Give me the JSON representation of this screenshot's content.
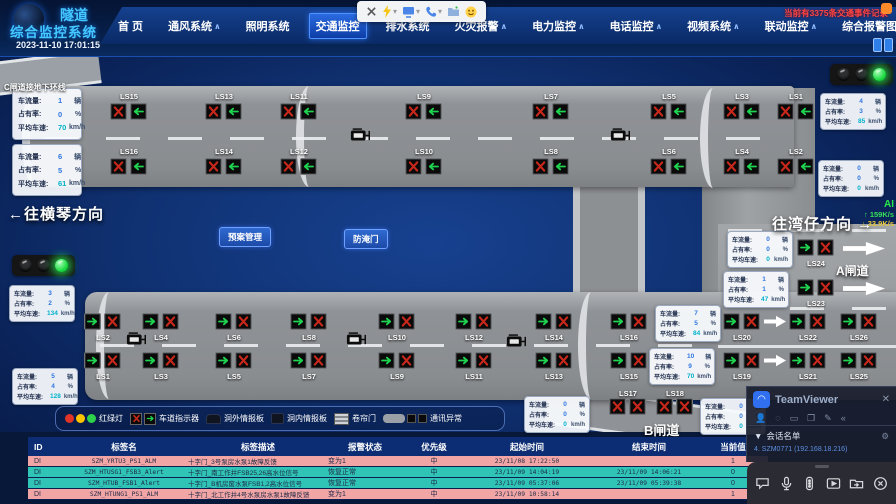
{
  "header": {
    "logo_line1": "隧道",
    "logo_line2": "综合监控系统",
    "timestamp": "2023-11-10 17:01:15",
    "alert_notice": "当前有3375条交通事件记录",
    "nav": [
      {
        "label": "首 页"
      },
      {
        "label": "通风系统",
        "arrow": true
      },
      {
        "label": "照明系统"
      },
      {
        "label": "交通监控",
        "active": true
      },
      {
        "label": "排水系统"
      },
      {
        "label": "火灾报警",
        "arrow": true
      },
      {
        "label": "电力监控",
        "arrow": true
      },
      {
        "label": "电话监控",
        "arrow": true
      },
      {
        "label": "视频系统",
        "arrow": true
      },
      {
        "label": "联动监控",
        "arrow": true
      },
      {
        "label": "综合报警图表",
        "arrow": true
      }
    ],
    "session_toolbar_icons": [
      "close-icon",
      "lightning-icon",
      "monitor-icon",
      "phone-icon",
      "folder-add-icon",
      "smiley-icon"
    ]
  },
  "scene": {
    "c_gate_label": "C闸道接地下环线",
    "direction_left": "←往横琴方向",
    "direction_right": "往湾仔方向 →",
    "gate_a_label": "A闸道",
    "gate_b_label": "B闸道",
    "plan_button": "预案管理",
    "flood_door_button": "防淹门",
    "net_monitor": {
      "title": "AI",
      "up": "159K/s",
      "down": "33.9K/s"
    },
    "panel_labels": {
      "flow": "车流量:",
      "occupancy": "占有率:",
      "speed": "平均车速:",
      "flow_unit": "辆",
      "occupancy_unit": "%",
      "speed_unit": "km/h"
    },
    "panels": [
      {
        "id": "c-gate-upper",
        "flow": "1",
        "occupancy": "0",
        "speed": "70"
      },
      {
        "id": "c-gate-lower",
        "flow": "6",
        "occupancy": "5",
        "speed": "61"
      },
      {
        "id": "west-upper",
        "flow": "3",
        "occupancy": "2",
        "speed": "134"
      },
      {
        "id": "west-lower",
        "flow": "5",
        "occupancy": "4",
        "speed": "128"
      },
      {
        "id": "east-top",
        "flow": "4",
        "occupancy": "3",
        "speed": "85"
      },
      {
        "id": "east-mid",
        "flow": "0",
        "occupancy": "0",
        "speed": "0"
      },
      {
        "id": "a-gate-upper",
        "flow": "0",
        "occupancy": "0",
        "speed": "0"
      },
      {
        "id": "a-gate-lower",
        "flow": "1",
        "occupancy": "1",
        "speed": "47"
      },
      {
        "id": "main-upper",
        "flow": "7",
        "occupancy": "5",
        "speed": "84"
      },
      {
        "id": "main-lower",
        "flow": "10",
        "occupancy": "9",
        "speed": "70"
      },
      {
        "id": "b-gate-left",
        "flow": "0",
        "occupancy": "0",
        "speed": "0"
      },
      {
        "id": "b-gate-right",
        "flow": "0",
        "occupancy": "0",
        "speed": "0"
      }
    ],
    "tunnel_signs": {
      "top_row1": [
        "LS15",
        "LS13",
        "LS11",
        "LS9",
        "LS7",
        "LS5",
        "LS3",
        "LS1"
      ],
      "top_row2": [
        "LS16",
        "LS14",
        "LS12",
        "LS10",
        "LS8",
        "LS6",
        "LS4",
        "LS2"
      ],
      "bottom_row1": [
        "LS2",
        "LS4",
        "LS6",
        "LS8",
        "LS10",
        "LS12",
        "LS14",
        "LS16",
        "LS20",
        "LS22",
        "LS26"
      ],
      "bottom_row2": [
        "LS1",
        "LS3",
        "LS5",
        "LS7",
        "LS9",
        "LS11",
        "LS13",
        "LS15",
        "LS19",
        "LS21",
        "LS25"
      ],
      "ramp_a": [
        "LS24",
        "LS23"
      ],
      "ramp_b": [
        "LS17",
        "LS18"
      ]
    }
  },
  "legend": {
    "items": [
      {
        "icon": "traffic-light-icon",
        "label": "红绿灯"
      },
      {
        "icon": "lane-indicator-icon",
        "label": "车道指示器"
      },
      {
        "icon": "outdoor-board-icon",
        "label": "洞外情报板"
      },
      {
        "icon": "indoor-board-icon",
        "label": "洞内情报板"
      },
      {
        "icon": "roller-door-icon",
        "label": "卷帘门"
      },
      {
        "icon": "comm-error-icon",
        "label": "通讯异常"
      }
    ]
  },
  "alarm_table": {
    "columns": [
      "ID",
      "标签名",
      "标签描述",
      "报警状态",
      "优先级",
      "起始时间",
      "结束时间",
      "当前值"
    ],
    "rows": [
      {
        "id": "DI",
        "tag": "SZM_YRTU3_PS1_ALM",
        "desc": "十字门_3号泵房水泵1故障反馈",
        "status": "变为1",
        "priority": "中",
        "start": "23/11/08 17:22:50",
        "end": "",
        "value": "1",
        "tone": "alarm"
      },
      {
        "id": "DI",
        "tag": "SZM_HTUSG1_FSB3_Alert",
        "desc": "十字门_南工作井FSB25,26高水位信号",
        "status": "恢复正常",
        "priority": "中",
        "start": "23/11/09 14:04:19",
        "end": "23/11/09 14:06:21",
        "value": "0",
        "tone": "normal"
      },
      {
        "id": "DI",
        "tag": "SZM_HTUB_FSB1_Alert",
        "desc": "十字门_B机房废水泵FSB1,2高水位信号",
        "status": "恢复正常",
        "priority": "中",
        "start": "23/11/09 05:37:06",
        "end": "23/11/09 05:39:38",
        "value": "0",
        "tone": "normal"
      },
      {
        "id": "DI",
        "tag": "SZM_HTUNG1_PS1_ALM",
        "desc": "十字门_北工作井4号水泵房水泵1故障反馈",
        "status": "变为1",
        "priority": "中",
        "start": "23/11/09 10:58:14",
        "end": "",
        "value": "1",
        "tone": "alarm"
      }
    ]
  },
  "teamviewer": {
    "title": "TeamViewer",
    "session_menu": "会话名单",
    "session_entry": "4. SZM0771 (192.168.18.216)",
    "toolbar_icons": [
      "chat-icon",
      "mic-icon",
      "remote-control-icon",
      "video-icon",
      "file-transfer-icon",
      "end-session-icon"
    ]
  }
}
